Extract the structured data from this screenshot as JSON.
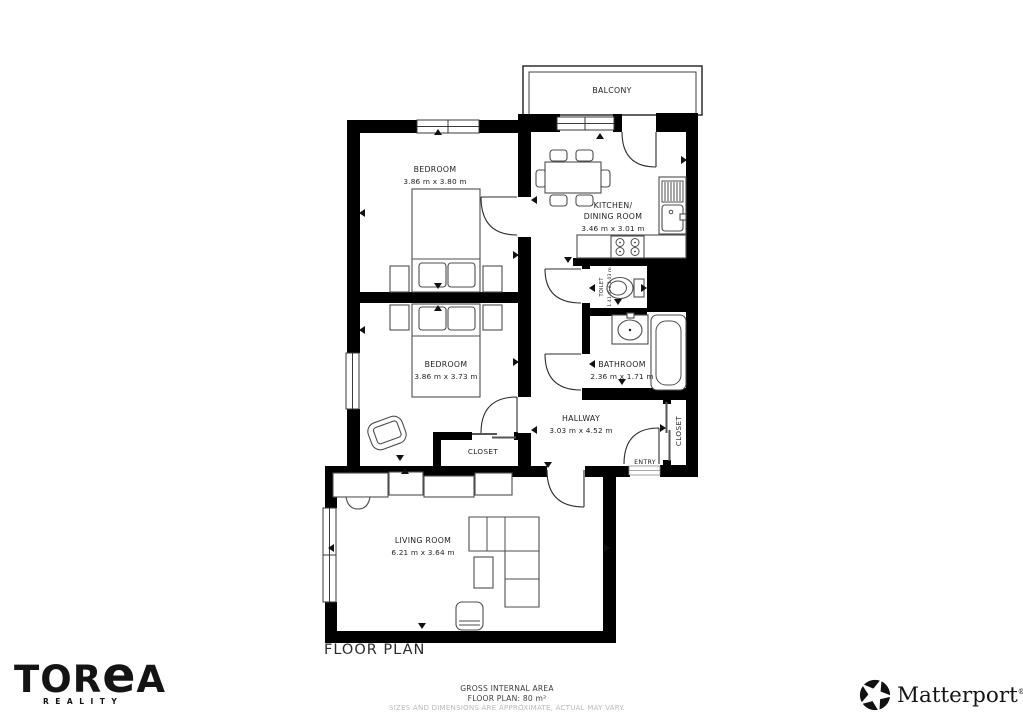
{
  "plan": {
    "title": "FLOOR PLAN",
    "rooms": {
      "balcony": {
        "label": "BALCONY"
      },
      "bedroom_top": {
        "label": "BEDROOM",
        "dims": "3.86 m x 3.80 m"
      },
      "kitchen_dining": {
        "label_line1": "KITCHEN/",
        "label_line2": "DINING ROOM",
        "dims": "3.46 m x 3.01 m"
      },
      "bedroom_middle": {
        "label": "BEDROOM",
        "dims": "3.86 m x 3.73 m"
      },
      "toilet": {
        "label": "TOILET",
        "dims": "1.41 m x 1.03 m"
      },
      "bathroom": {
        "label": "BATHROOM",
        "dims": "2.36 m x 1.71 m"
      },
      "hallway": {
        "label": "HALLWAY",
        "dims": "3.03 m x 4.52 m"
      },
      "closet_bedroom": {
        "label": "CLOSET"
      },
      "closet_hallway": {
        "label": "CLOSET"
      },
      "entry": {
        "label": "ENTRY"
      },
      "living_room": {
        "label": "LIVING ROOM",
        "dims": "6.21 m x 3.64 m"
      }
    }
  },
  "footer": {
    "gross_area_label": "GROSS INTERNAL AREA",
    "floor_plan_area": "FLOOR PLAN: 80 m²",
    "disclaimer": "SIZES AND DIMENSIONS ARE APPROXIMATE, ACTUAL MAY VARY."
  },
  "branding": {
    "agency": {
      "name_prefix": "TOR",
      "name_stylized_e": "e",
      "name_suffix": "A",
      "subtitle": "REALITY"
    },
    "partner": {
      "name": "Matterport",
      "registered_mark": "®"
    }
  },
  "colors": {
    "wall": "#000000",
    "furniture_outline": "#4d4d4d",
    "label_text": "#1e1e1e",
    "muted_text": "#b9b9b9"
  }
}
